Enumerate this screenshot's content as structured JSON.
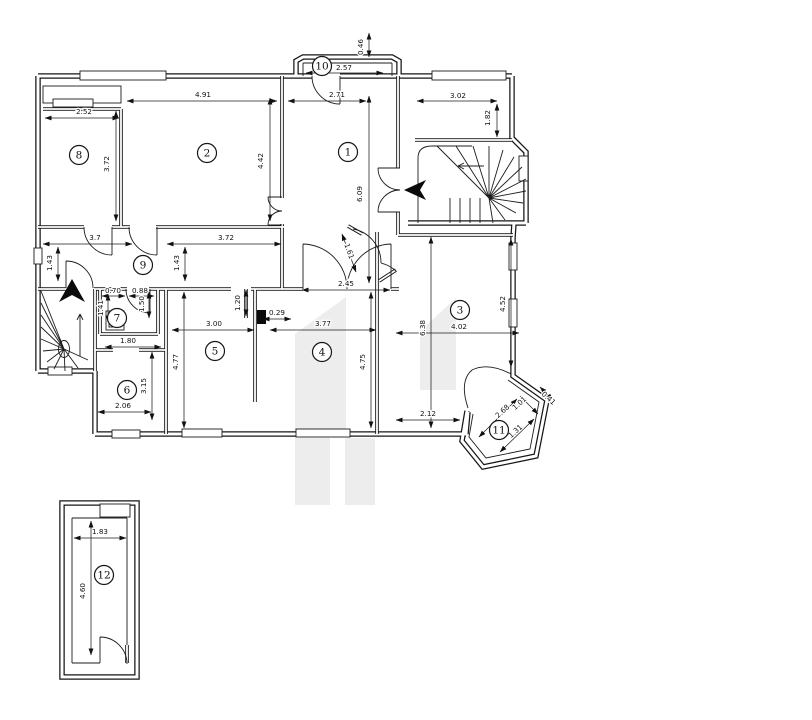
{
  "colors": {
    "line": "#161616",
    "background": "#ffffff",
    "watermark": "#ededed"
  },
  "rooms": [
    {
      "label": "1",
      "x": 348,
      "y": 152
    },
    {
      "label": "2",
      "x": 207,
      "y": 153
    },
    {
      "label": "3",
      "x": 460,
      "y": 310
    },
    {
      "label": "4",
      "x": 322,
      "y": 352
    },
    {
      "label": "5",
      "x": 215,
      "y": 351
    },
    {
      "label": "6",
      "x": 127,
      "y": 390
    },
    {
      "label": "7",
      "x": 117,
      "y": 318
    },
    {
      "label": "8",
      "x": 79,
      "y": 155
    },
    {
      "label": "9",
      "x": 143,
      "y": 265
    },
    {
      "label": "10",
      "x": 322,
      "y": 66
    },
    {
      "label": "11",
      "x": 499,
      "y": 430
    },
    {
      "label": "12",
      "x": 104,
      "y": 575
    }
  ],
  "dimensions": [
    {
      "value": "0.46",
      "x": 363,
      "y": 47,
      "rotate": -90,
      "line": [
        369,
        33,
        369,
        57
      ]
    },
    {
      "value": "2.57",
      "x": 344,
      "y": 70,
      "rotate": 0,
      "line": [
        306,
        73,
        383,
        73
      ]
    },
    {
      "value": "2.71",
      "x": 337,
      "y": 97,
      "rotate": 0,
      "line": [
        288,
        101,
        366,
        101
      ]
    },
    {
      "value": "3.02",
      "x": 458,
      "y": 98,
      "rotate": 0,
      "line": [
        417,
        101,
        497,
        101
      ]
    },
    {
      "value": "1.82",
      "x": 490,
      "y": 118,
      "rotate": -90,
      "line": [
        497,
        104,
        497,
        137
      ]
    },
    {
      "value": "4.91",
      "x": 203,
      "y": 97,
      "rotate": 0,
      "line": [
        127,
        101,
        277,
        101
      ]
    },
    {
      "value": "2.52",
      "x": 84,
      "y": 114,
      "rotate": 0,
      "line": [
        45,
        118,
        119,
        118
      ]
    },
    {
      "value": "3.72",
      "x": 109,
      "y": 164,
      "rotate": -90,
      "line": [
        116,
        111,
        116,
        221
      ]
    },
    {
      "value": "4.42",
      "x": 263,
      "y": 161,
      "rotate": -90,
      "line": [
        270,
        98,
        270,
        221
      ]
    },
    {
      "value": "6.09",
      "x": 362,
      "y": 194,
      "rotate": -90,
      "line": [
        369,
        96,
        369,
        283
      ]
    },
    {
      "value": "3.7",
      "x": 95,
      "y": 240,
      "rotate": 0,
      "line": [
        43,
        244,
        132,
        244
      ]
    },
    {
      "value": "3.72",
      "x": 226,
      "y": 240,
      "rotate": 0,
      "line": [
        167,
        244,
        281,
        244
      ]
    },
    {
      "value": "1.43",
      "x": 52,
      "y": 263,
      "rotate": -90,
      "line": [
        58,
        247,
        58,
        281
      ]
    },
    {
      "value": "1.43",
      "x": 179,
      "y": 263,
      "rotate": -90,
      "line": [
        185,
        247,
        185,
        281
      ]
    },
    {
      "value": "2.45",
      "x": 346,
      "y": 286,
      "rotate": 0,
      "line": [
        302,
        290,
        390,
        290
      ]
    },
    {
      "value": "1.61",
      "x": 347,
      "y": 252,
      "rotate": 70,
      "line": [
        342,
        234,
        356,
        272
      ]
    },
    {
      "value": "0.70",
      "x": 113,
      "y": 293,
      "rotate": 0,
      "line": [
        102,
        296,
        125,
        296
      ]
    },
    {
      "value": "0.88",
      "x": 140,
      "y": 293,
      "rotate": 0,
      "line": [
        129,
        296,
        154,
        296
      ]
    },
    {
      "value": "1.41",
      "x": 103,
      "y": 308,
      "rotate": -90,
      "line": [
        108,
        294,
        108,
        322
      ]
    },
    {
      "value": "1.50",
      "x": 144,
      "y": 304,
      "rotate": -90,
      "line": [
        149,
        292,
        149,
        318
      ]
    },
    {
      "value": "1.20",
      "x": 240,
      "y": 303,
      "rotate": -90,
      "line": [
        246,
        290,
        246,
        316
      ]
    },
    {
      "value": "0.29",
      "x": 277,
      "y": 315,
      "rotate": 0,
      "line": [
        263,
        319,
        291,
        319
      ]
    },
    {
      "value": "3.00",
      "x": 214,
      "y": 326,
      "rotate": 0,
      "line": [
        172,
        330,
        254,
        330
      ]
    },
    {
      "value": "3.77",
      "x": 323,
      "y": 326,
      "rotate": 0,
      "line": [
        270,
        330,
        376,
        330
      ]
    },
    {
      "value": "4.02",
      "x": 459,
      "y": 329,
      "rotate": 0,
      "line": [
        396,
        333,
        519,
        333
      ]
    },
    {
      "value": "6.38",
      "x": 425,
      "y": 328,
      "rotate": -90,
      "line": [
        431,
        237,
        431,
        428
      ]
    },
    {
      "value": "4.52",
      "x": 505,
      "y": 304,
      "rotate": -90,
      "line": [
        511,
        239,
        511,
        367
      ]
    },
    {
      "value": "1.80",
      "x": 128,
      "y": 343,
      "rotate": 0,
      "line": [
        105,
        347,
        161,
        347
      ]
    },
    {
      "value": "4.77",
      "x": 178,
      "y": 362,
      "rotate": -90,
      "line": [
        184,
        292,
        184,
        428
      ]
    },
    {
      "value": "4.75",
      "x": 365,
      "y": 362,
      "rotate": -90,
      "line": [
        371,
        292,
        371,
        428
      ]
    },
    {
      "value": "3.15",
      "x": 146,
      "y": 386,
      "rotate": -90,
      "line": [
        152,
        352,
        152,
        420
      ]
    },
    {
      "value": "2.06",
      "x": 123,
      "y": 408,
      "rotate": 0,
      "line": [
        98,
        412,
        151,
        412
      ]
    },
    {
      "value": "2.12",
      "x": 428,
      "y": 416,
      "rotate": 0,
      "line": [
        396,
        420,
        460,
        420
      ]
    },
    {
      "value": "2.68",
      "x": 504,
      "y": 413,
      "rotate": -42,
      "line": [
        479,
        437,
        517,
        399
      ]
    },
    {
      "value": "1.01",
      "x": 521,
      "y": 405,
      "rotate": -42,
      "line": [
        520,
        396,
        538,
        414
      ]
    },
    {
      "value": "1.31",
      "x": 517,
      "y": 433,
      "rotate": -42,
      "line": [
        500,
        452,
        534,
        419
      ]
    },
    {
      "value": "0.41",
      "x": 547,
      "y": 400,
      "rotate": 42,
      "line": [
        540,
        387,
        553,
        400
      ]
    },
    {
      "value": "1.83",
      "x": 100,
      "y": 534,
      "rotate": 0,
      "line": [
        74,
        538,
        126,
        538
      ]
    },
    {
      "value": "4.60",
      "x": 85,
      "y": 591,
      "rotate": -90,
      "line": [
        91,
        521,
        91,
        655
      ]
    }
  ]
}
